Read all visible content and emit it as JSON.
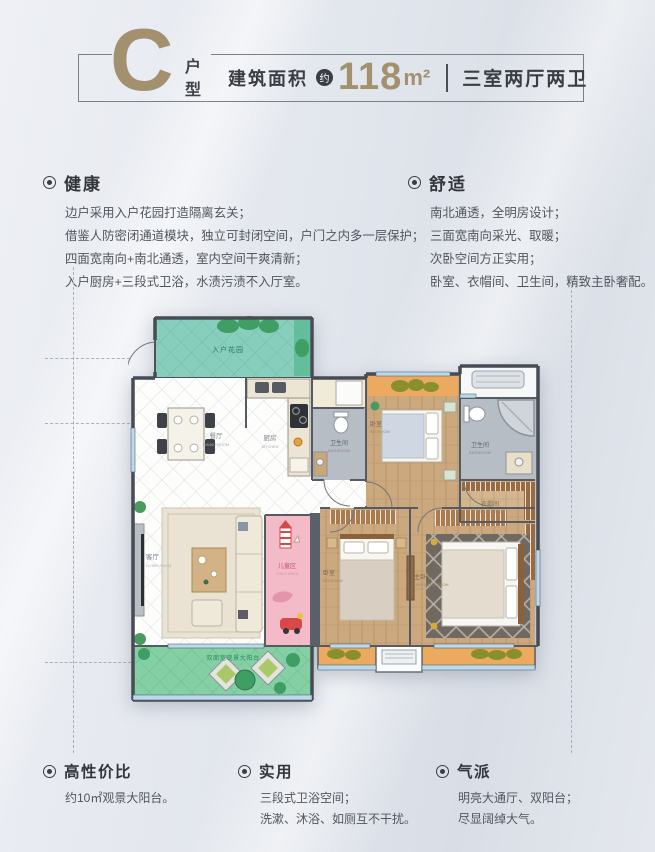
{
  "header": {
    "type_letter": "C",
    "type_label_1": "户",
    "type_label_2": "型",
    "area_prefix": "建筑面积",
    "area_approx": "约",
    "area_value": "118",
    "area_unit": "m²",
    "layout_text": "三室两厅两卫"
  },
  "features": {
    "health": {
      "title": "健康",
      "lines": [
        "边户采用入户花园打造隔离玄关；",
        "借鉴人防密闭通道模块，独立可封闭空间，户门之内多一层保护；",
        "四面宽南向+南北通透，室内空间干爽清新；",
        "入户厨房+三段式卫浴，水渍污渍不入厅室。"
      ]
    },
    "comfort": {
      "title": "舒适",
      "lines": [
        "南北通透，全明房设计；",
        "三面宽南向采光、取暖；",
        "次卧空间方正实用；",
        "卧室、衣帽间、卫生间，精致主卧奢配。"
      ]
    }
  },
  "floorplan": {
    "rooms": [
      {
        "cn": "入户花园",
        "en": ""
      },
      {
        "cn": "餐厅",
        "en": "DINING ROOM"
      },
      {
        "cn": "厨房",
        "en": "KITCHEN"
      },
      {
        "cn": "卫生间",
        "en": "BATHROOM"
      },
      {
        "cn": "卧室",
        "en": "BEDROOM"
      },
      {
        "cn": "卫生间",
        "en": "BATHROOM"
      },
      {
        "cn": "衣帽间",
        "en": "CLOAKROOM"
      },
      {
        "cn": "客厅",
        "en": "LIVING ROOM"
      },
      {
        "cn": "儿童区",
        "en": "CHILD AREA"
      },
      {
        "cn": "卧室",
        "en": "BEDROOM"
      },
      {
        "cn": "主卧室",
        "en": "MASTER BEDROOM"
      },
      {
        "cn": "双面宽观景大阳台",
        "en": ""
      }
    ]
  },
  "footers": [
    {
      "title": "高性价比",
      "lines": [
        "约10㎡观景大阳台。"
      ]
    },
    {
      "title": "实用",
      "lines": [
        "三段式卫浴空间；",
        "洗漱、沐浴、如厕互不干扰。"
      ]
    },
    {
      "title": "气派",
      "lines": [
        "明亮大通厅、双阳台；",
        "尽显阔绰大气。"
      ]
    }
  ],
  "colors": {
    "accent_tan": "#a3906f",
    "dark_text": "#3a3e44",
    "garden_green": "#87cfbc",
    "balcony_green": "#84cfa4",
    "balcony_orange": "#ecaa60",
    "wood_floor": "#cba87d",
    "bath_gray": "#b6bdc4",
    "kids_pink": "#f3bac8",
    "window_blue": "#7fb8dc"
  }
}
